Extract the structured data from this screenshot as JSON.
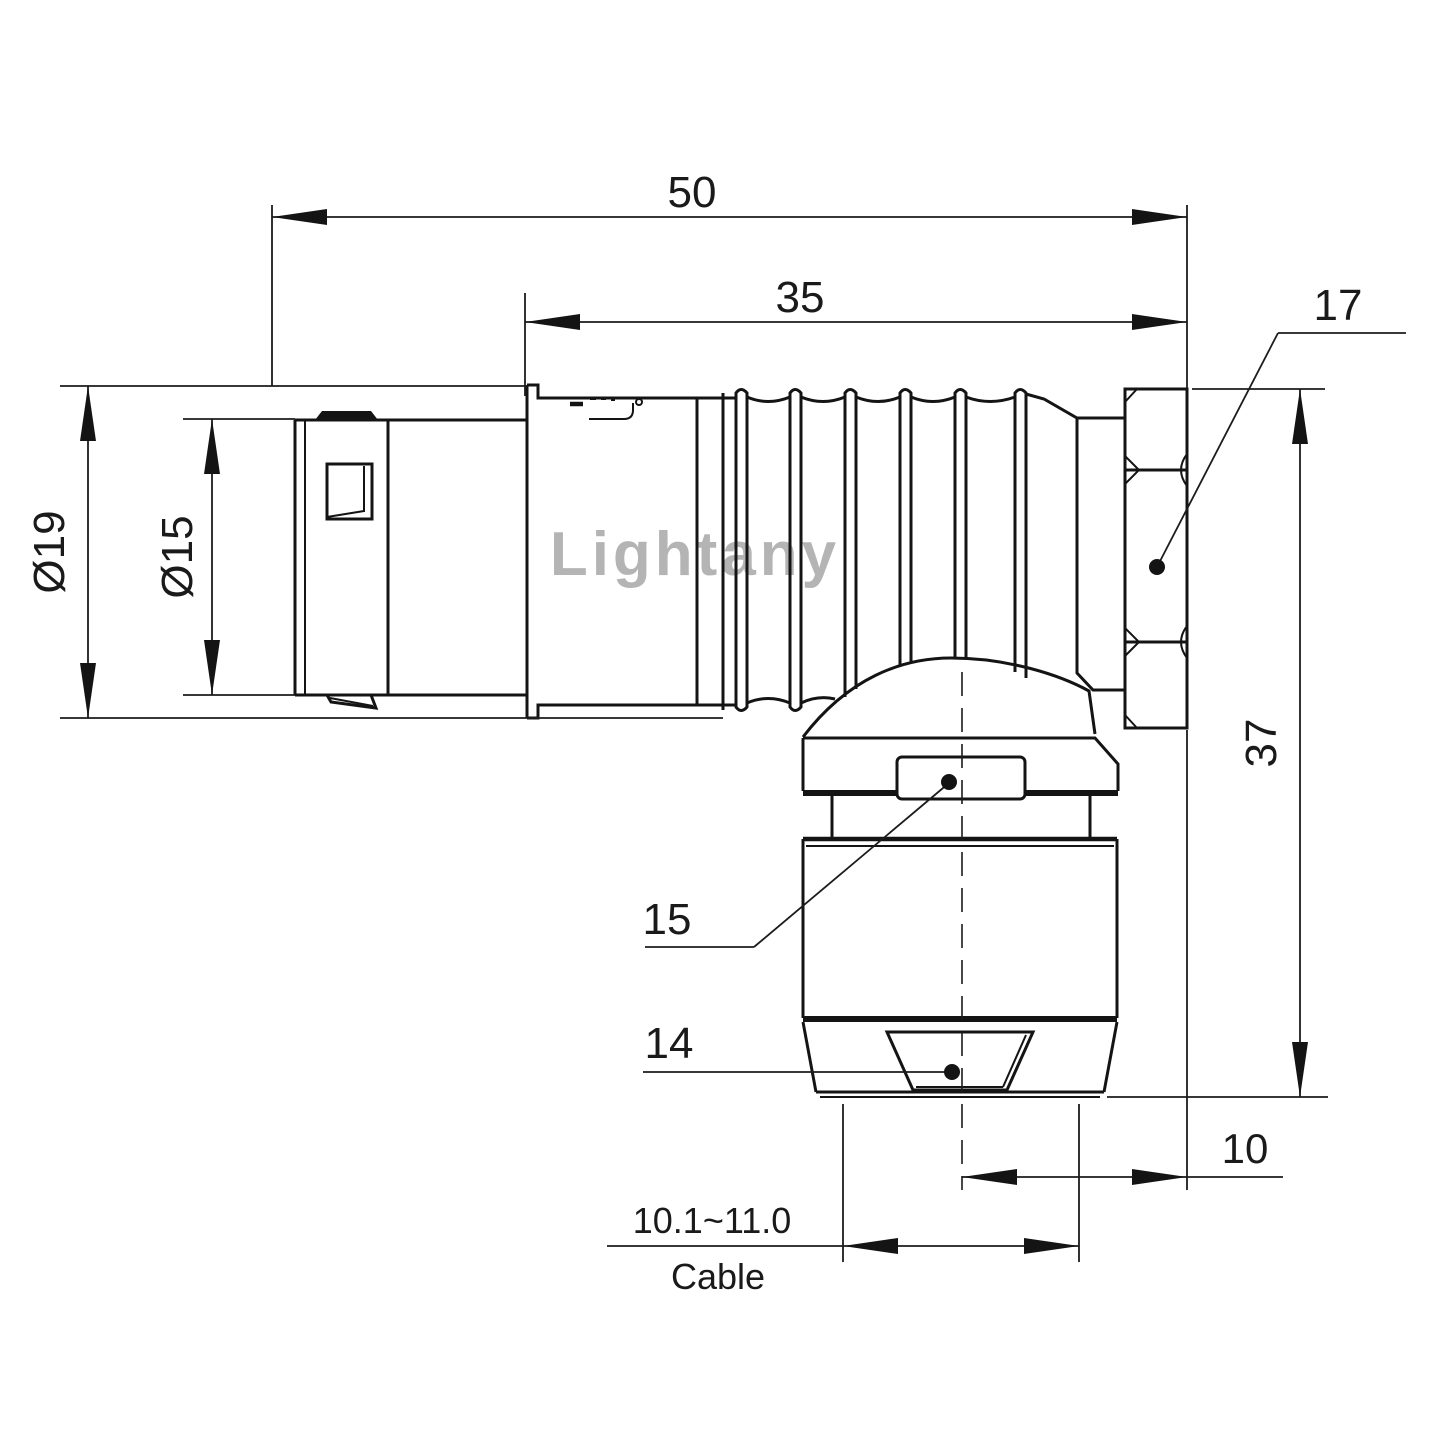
{
  "page": {
    "background": "#ffffff",
    "line_color": "#141414"
  },
  "watermark": {
    "text": "Lightany",
    "color": "#d98c8c"
  },
  "dimensions": {
    "total_length": {
      "label": "50",
      "value": 50
    },
    "body_length": {
      "label": "35",
      "value": 35
    },
    "outer_diameter": {
      "label": "Ø19",
      "value": 19
    },
    "inner_diameter": {
      "label": "Ø15",
      "value": 15
    },
    "height": {
      "label": "37",
      "value": 37
    },
    "axis_to_rear_face": {
      "label": "10",
      "value": 10
    },
    "cable_clamp_range": {
      "label": "10.1~11.0",
      "caption": "Cable",
      "min": 10.1,
      "max": 11.0
    }
  },
  "callouts": {
    "part_17": {
      "label": "17"
    },
    "part_15": {
      "label": "15"
    },
    "part_14": {
      "label": "14"
    }
  }
}
